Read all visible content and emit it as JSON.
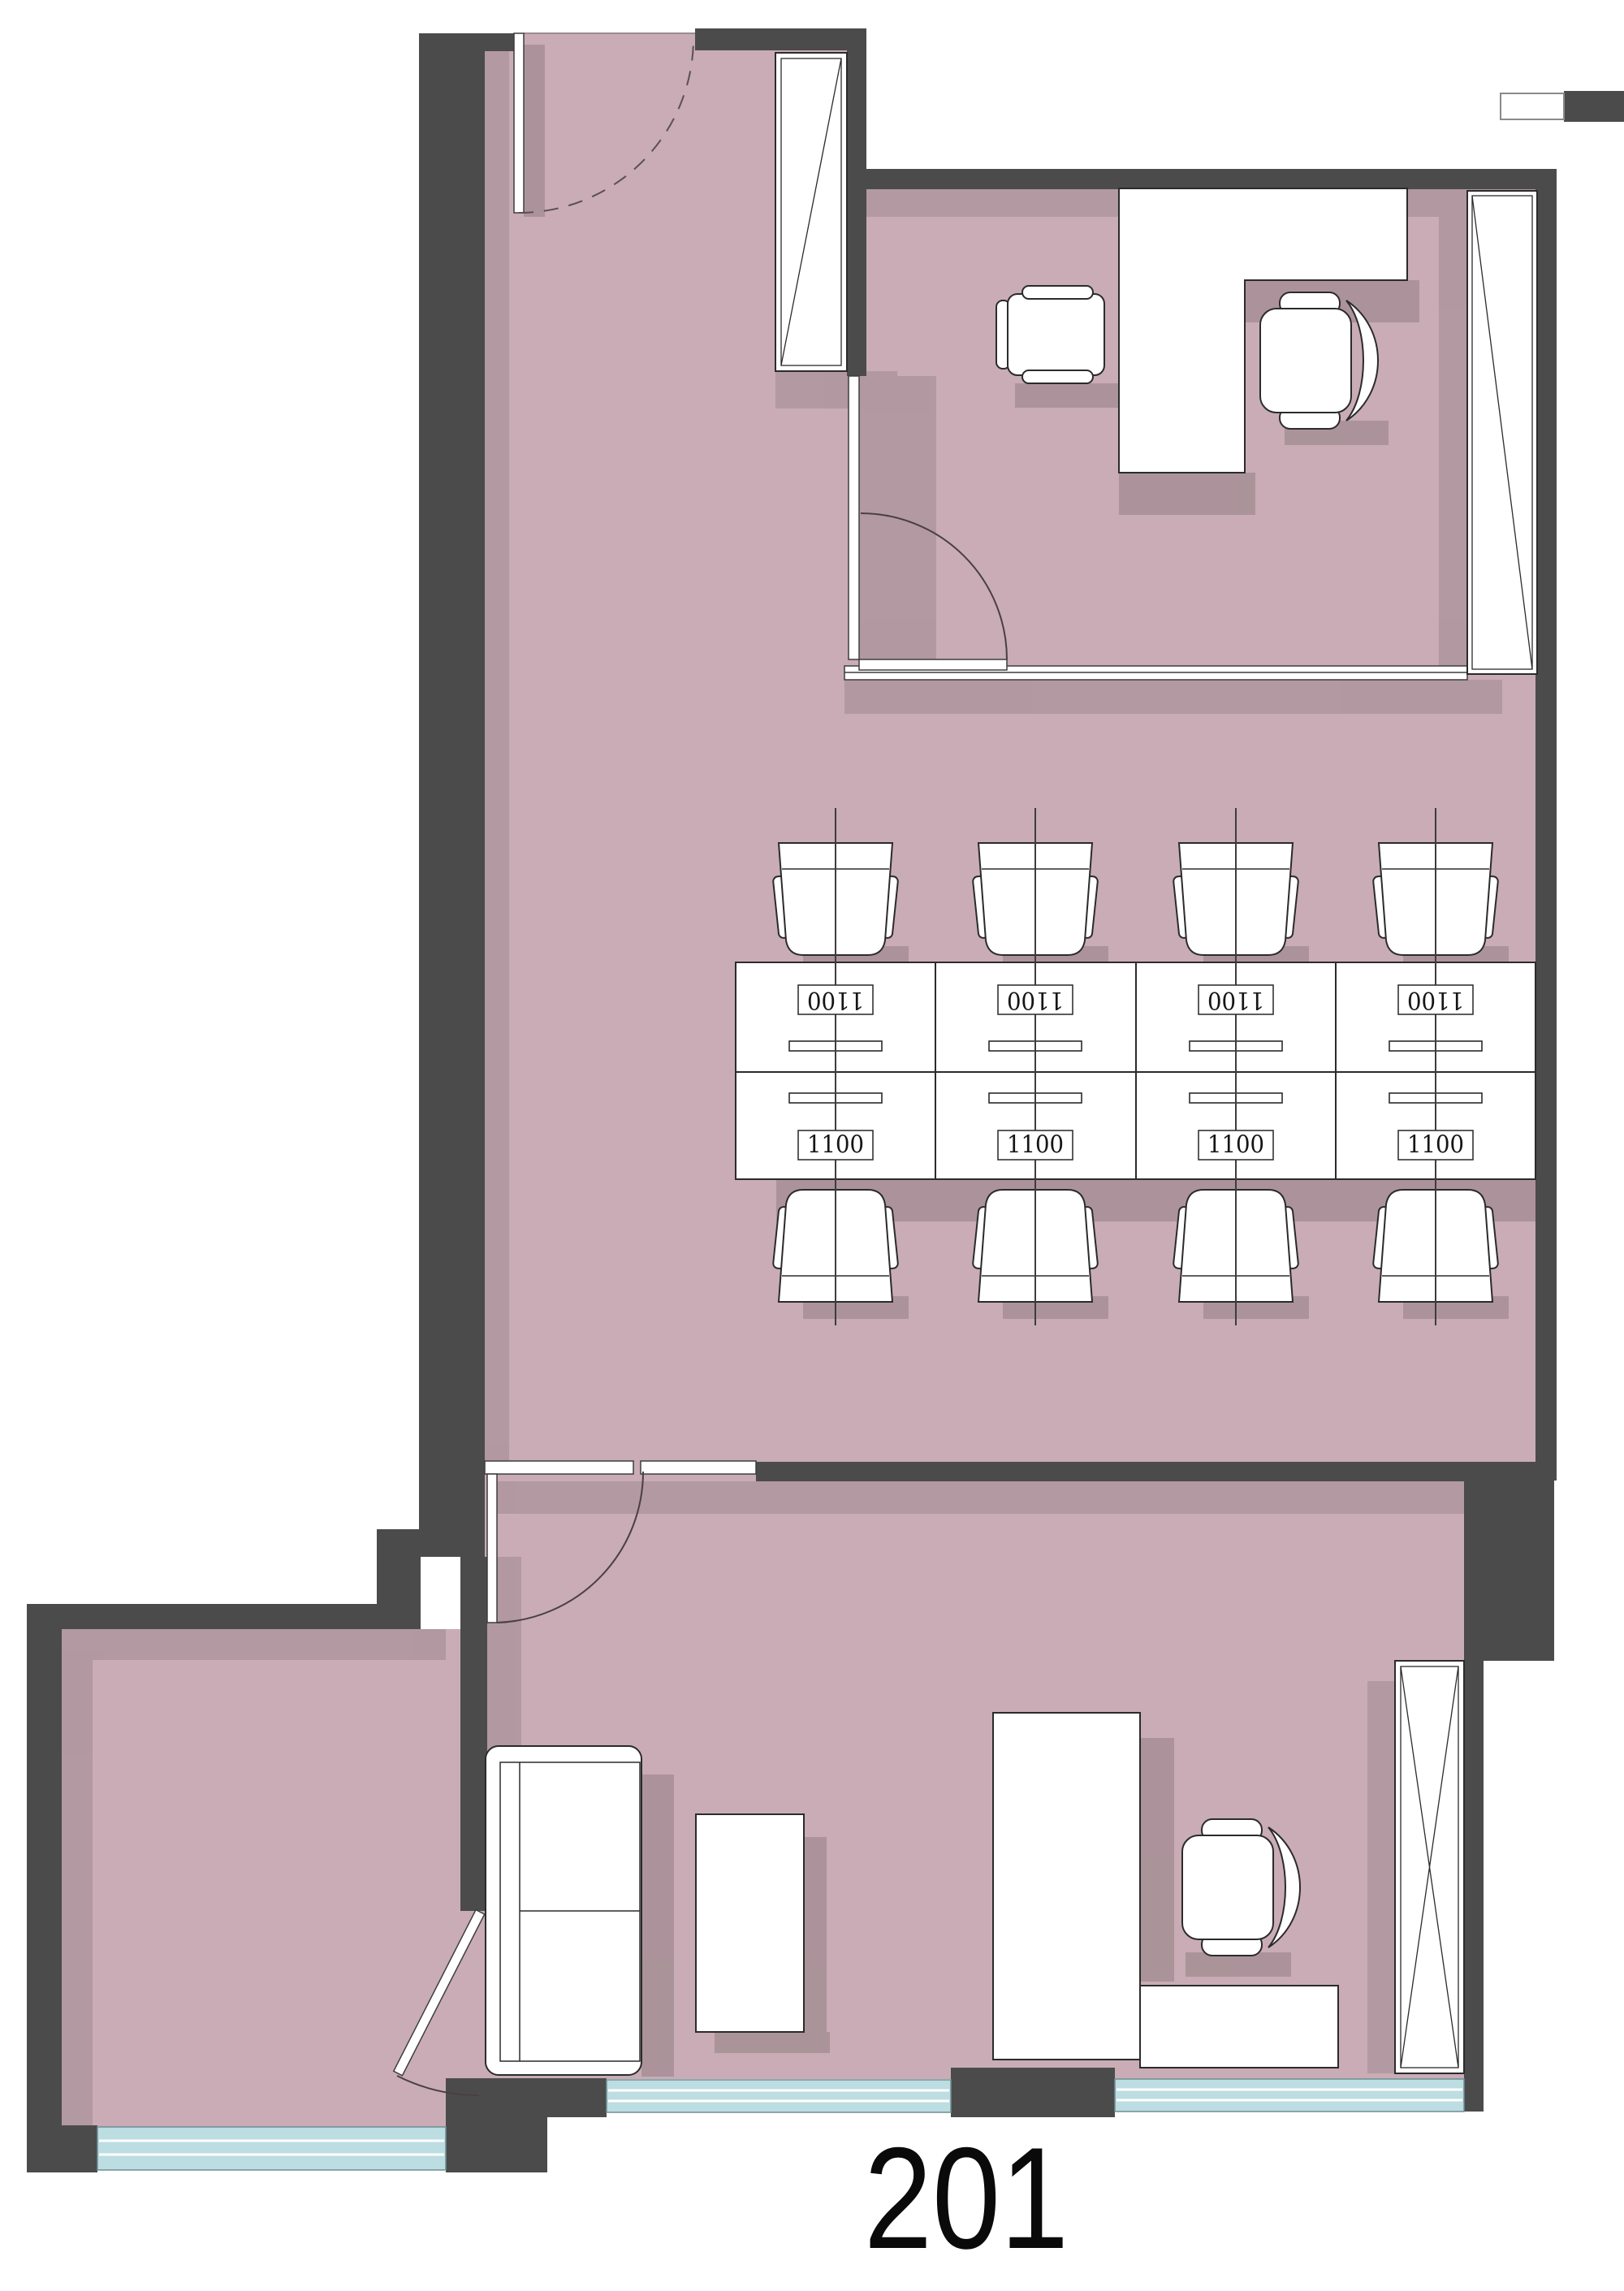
{
  "title": {
    "text": "201"
  },
  "labels": {
    "desk_dimension": "1100"
  },
  "colors": {
    "background": "#ffffff",
    "floor": "#c9acb5",
    "wall": "#4b4b4b",
    "window_glass": "#bcdde2",
    "furniture_fill": "#ffffff",
    "outline": "#2b2b2b",
    "centerline": "#3d3d3d",
    "arc": "#4a3f44",
    "title_color": "#0a0a0a"
  }
}
